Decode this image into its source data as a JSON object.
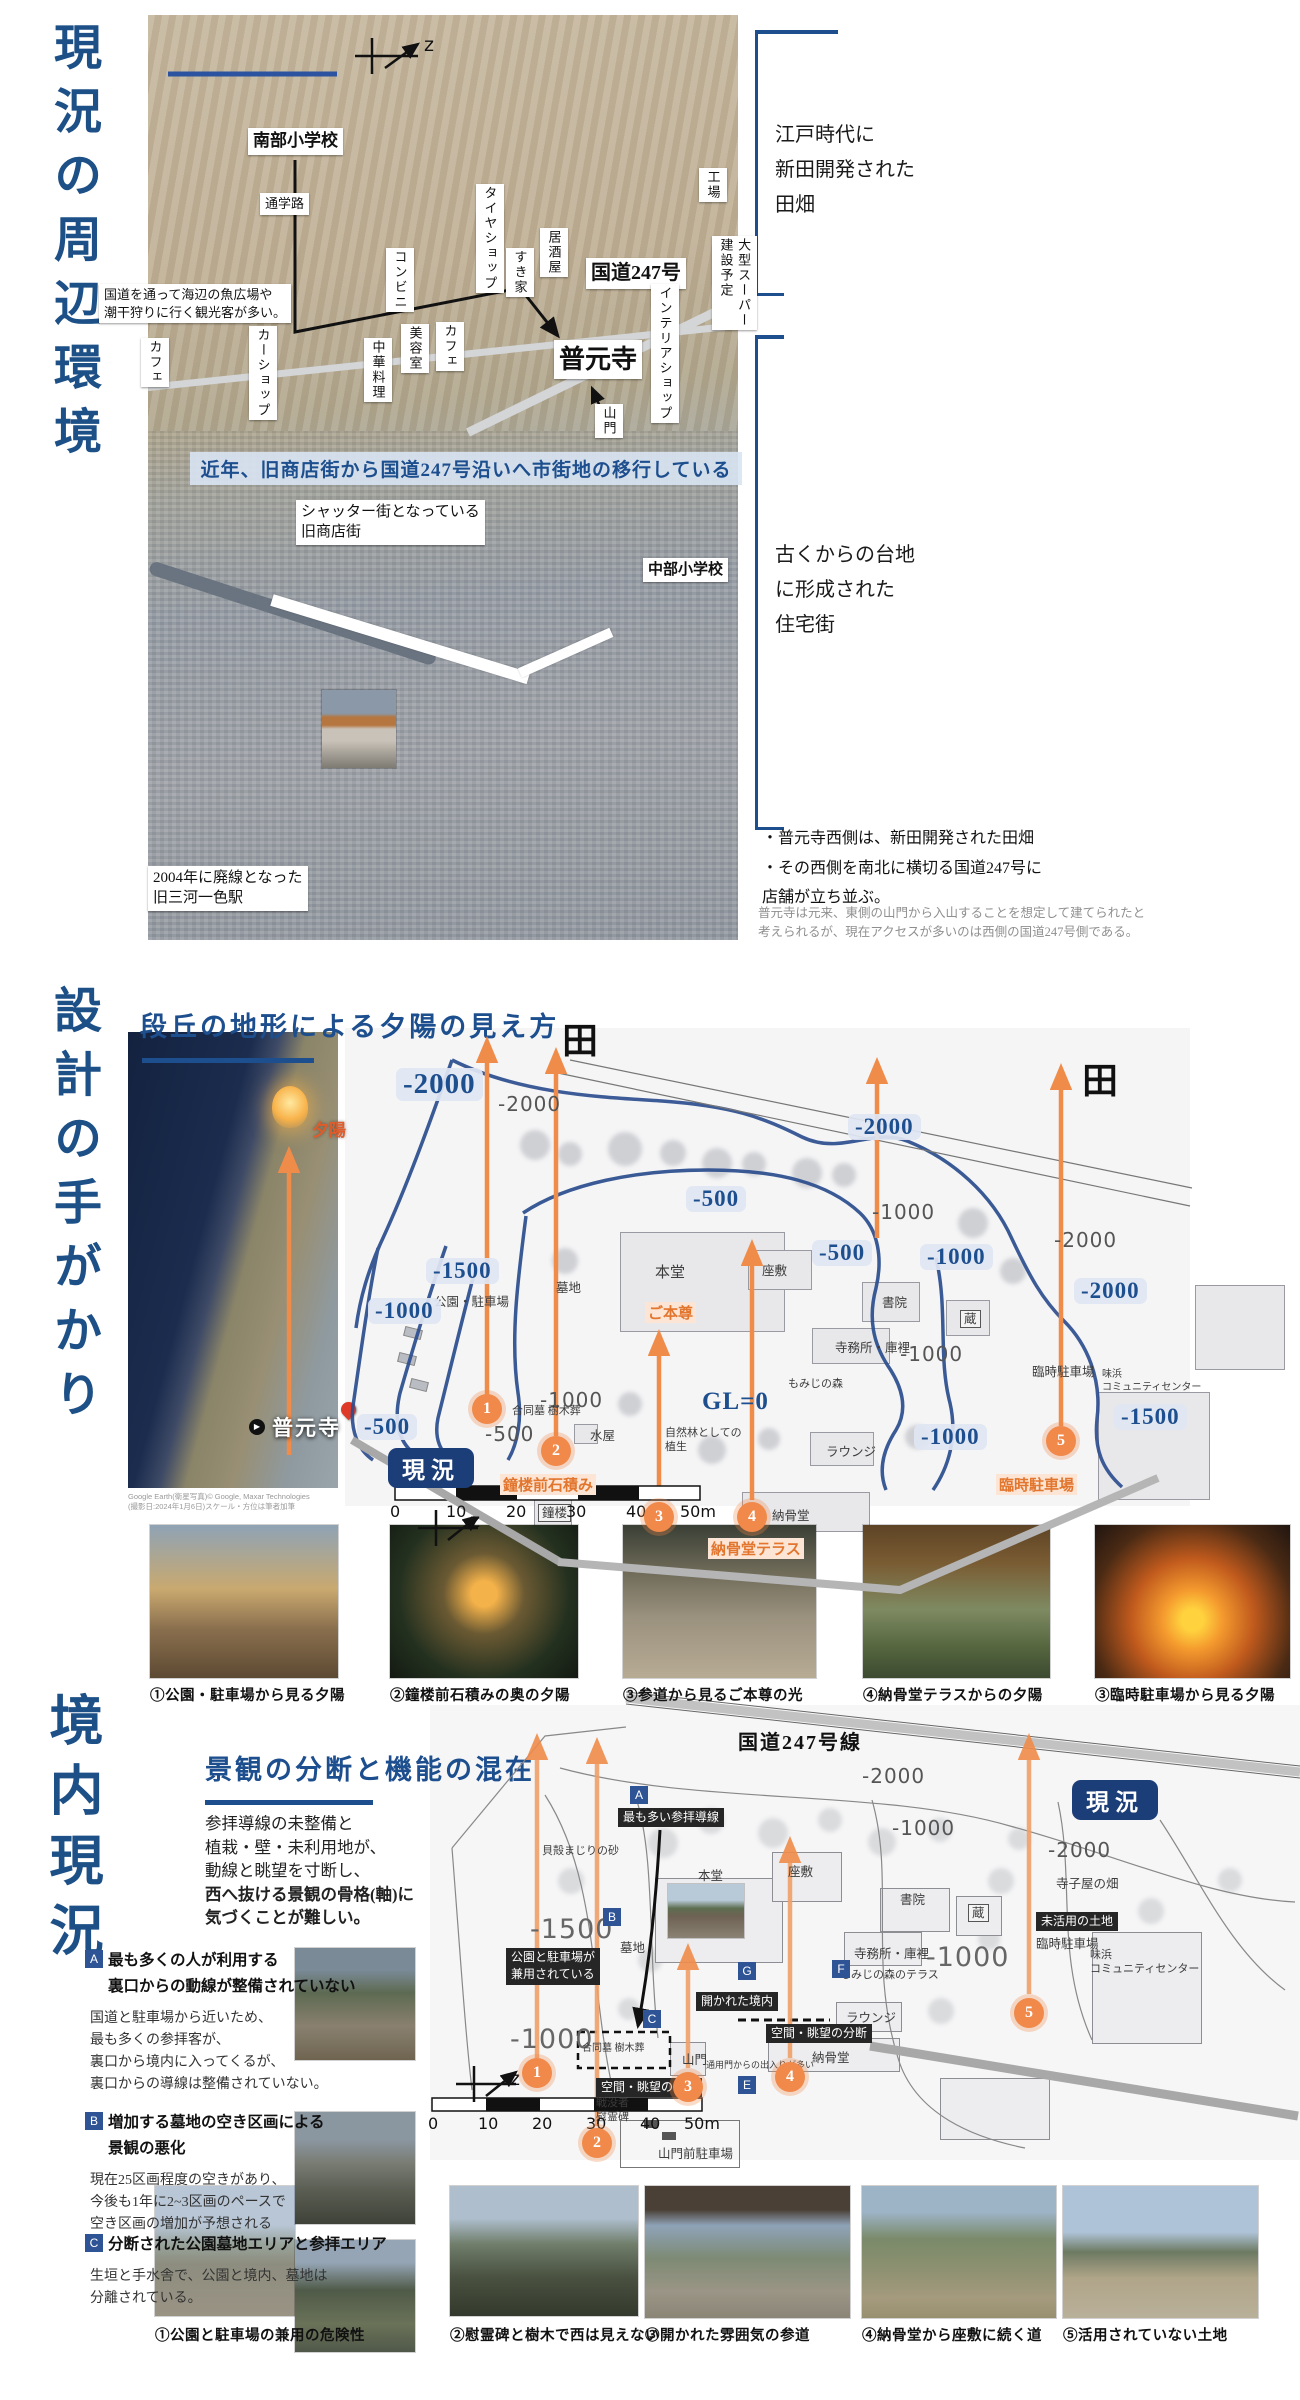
{
  "section1": {
    "title": "現況の周辺環境",
    "banner": "近年、旧商店街から国道247号沿いへ市街地の移行している",
    "map_labels": [
      {
        "t": "南部小学校",
        "x": 248,
        "y": 128,
        "b": 1,
        "s": 17
      },
      {
        "t": "通学路",
        "x": 260,
        "y": 193
      },
      {
        "t": "国道を通って海辺の魚広場や\n潮干狩りに行く観光客が多い。",
        "x": 99,
        "y": 284
      },
      {
        "t": "コンビニ",
        "x": 386,
        "y": 248,
        "v": 1
      },
      {
        "t": "タイヤショップ",
        "x": 476,
        "y": 184,
        "v": 1
      },
      {
        "t": "すき家",
        "x": 506,
        "y": 248,
        "v": 1
      },
      {
        "t": "居酒屋",
        "x": 540,
        "y": 228,
        "v": 1
      },
      {
        "t": "工場",
        "x": 699,
        "y": 168,
        "v": 1
      },
      {
        "t": "国道247号",
        "x": 586,
        "y": 258,
        "b": 1,
        "s": 20
      },
      {
        "t": "インテリアショップ",
        "x": 651,
        "y": 284,
        "v": 1
      },
      {
        "t": "大型スーパー\n建設予定",
        "x": 712,
        "y": 236,
        "v": 1
      },
      {
        "t": "カフェ",
        "x": 141,
        "y": 338,
        "v": 1
      },
      {
        "t": "カーショップ",
        "x": 249,
        "y": 326,
        "v": 1
      },
      {
        "t": "中華料理",
        "x": 364,
        "y": 338,
        "v": 1
      },
      {
        "t": "美容室",
        "x": 401,
        "y": 324,
        "v": 1
      },
      {
        "t": "カフェ",
        "x": 436,
        "y": 322,
        "v": 1
      },
      {
        "t": "普元寺",
        "x": 554,
        "y": 340,
        "b": 1,
        "s": 26
      },
      {
        "t": "山門",
        "x": 595,
        "y": 404,
        "v": 1
      },
      {
        "t": "シャッター街となっている\n旧商店街",
        "x": 296,
        "y": 500,
        "s": 15
      },
      {
        "t": "中部小学校",
        "x": 643,
        "y": 558,
        "b": 1,
        "s": 15
      },
      {
        "t": "2004年に廃線となった\n旧三河一色駅",
        "x": 148,
        "y": 866,
        "s": 15
      },
      {
        "t": "z",
        "x": 424,
        "y": 34,
        "c": "zlet",
        "n": "north-arrow-label"
      }
    ],
    "right": {
      "bracket1": "江戸時代に\n新田開発された\n田畑",
      "bracket2": "古くからの台地\nに形成された\n住宅街",
      "bullets": "・普元寺西側は、新田開発された田畑\n・その西側を南北に横切る国道247号に\n店舗が立ち並ぶ。",
      "note": "普元寺は元来、東側の山門から入山することを想定して建てられたと\n考えられるが、現在アクセスが多いのは西側の国道247号側である。"
    }
  },
  "section2": {
    "title": "設計の手がかり",
    "heading": "段丘の地形による夕陽の見え方",
    "photo_labels": [
      {
        "t": "夕陽",
        "x": 312,
        "y": 1116,
        "c": "sunlab",
        "n": "sunset-label"
      },
      {
        "t": "普元寺",
        "x": 272,
        "y": 1412,
        "c": "templelab",
        "n": "temple-name-label"
      },
      {
        "t": "▶",
        "x": 249,
        "y": 1419,
        "c": "playic",
        "n": "play-icon"
      },
      {
        "t": "Google Earth(衛星写真)© Google, Maxar Technologies",
        "x": 128,
        "y": 1491,
        "c": "credit",
        "n": "map-credit"
      },
      {
        "t": "(撮影日:2024年1月6日)スケール・方位は筆者加筆",
        "x": 128,
        "y": 1501,
        "c": "credit",
        "n": "map-credit"
      }
    ],
    "plan": {
      "badges": [
        {
          "t": "-2000",
          "x": 396,
          "y": 1068,
          "big": 1
        },
        {
          "t": "-1500",
          "x": 426,
          "y": 1258
        },
        {
          "t": "-1000",
          "x": 368,
          "y": 1298
        },
        {
          "t": "-500",
          "x": 357,
          "y": 1414
        },
        {
          "t": "-500",
          "x": 686,
          "y": 1186
        },
        {
          "t": "-2000",
          "x": 848,
          "y": 1114
        },
        {
          "t": "-500",
          "x": 812,
          "y": 1240
        },
        {
          "t": "-1000",
          "x": 920,
          "y": 1244
        },
        {
          "t": "-2000",
          "x": 1074,
          "y": 1278
        },
        {
          "t": "-1500",
          "x": 1114,
          "y": 1404
        },
        {
          "t": "-1000",
          "x": 914,
          "y": 1424
        }
      ],
      "plains": [
        {
          "t": "-2000",
          "x": 498,
          "y": 1092
        },
        {
          "t": "-1000",
          "x": 872,
          "y": 1200
        },
        {
          "t": "-2000",
          "x": 1054,
          "y": 1228
        },
        {
          "t": "-1000",
          "x": 900,
          "y": 1342
        },
        {
          "t": "-1000",
          "x": 540,
          "y": 1388
        },
        {
          "t": "-500",
          "x": 485,
          "y": 1422
        }
      ],
      "areas": [
        {
          "t": "公園・駐車場",
          "x": 434,
          "y": 1294
        },
        {
          "t": "墓地",
          "x": 556,
          "y": 1280
        },
        {
          "t": "本堂",
          "x": 655,
          "y": 1264,
          "s": 15
        },
        {
          "t": "座敷",
          "x": 762,
          "y": 1263
        },
        {
          "t": "書院",
          "x": 882,
          "y": 1295
        },
        {
          "t": "蔵",
          "x": 960,
          "y": 1310,
          "box": 1
        },
        {
          "t": "寺務所・庫裡",
          "x": 835,
          "y": 1340
        },
        {
          "t": "もみじの森",
          "x": 788,
          "y": 1377,
          "s": 11
        },
        {
          "t": "ラウンジ",
          "x": 826,
          "y": 1444
        },
        {
          "t": "臨時駐車場",
          "x": 1032,
          "y": 1364
        },
        {
          "t": "味浜\nコミュニティセンター",
          "x": 1102,
          "y": 1368,
          "s": 10
        },
        {
          "t": "水屋",
          "x": 590,
          "y": 1428
        },
        {
          "t": "合同墓 樹木葬",
          "x": 512,
          "y": 1404,
          "s": 11
        },
        {
          "t": "自然林としての\n植生",
          "x": 665,
          "y": 1426,
          "s": 11
        },
        {
          "t": "鐘楼",
          "x": 538,
          "y": 1504,
          "box": 1
        },
        {
          "t": "納骨堂",
          "x": 772,
          "y": 1508
        },
        {
          "t": "田",
          "x": 562,
          "y": 1012,
          "c": "ta",
          "n": "rice-field-label"
        },
        {
          "t": "田",
          "x": 1082,
          "y": 1052,
          "c": "ta",
          "n": "rice-field-label"
        },
        {
          "t": "GL=0",
          "x": 702,
          "y": 1388,
          "c": "gl",
          "n": "ground-level-label"
        },
        {
          "t": "現況",
          "x": 388,
          "y": 1448,
          "c": "statusbadge",
          "n": "status-badge"
        },
        {
          "t": "z",
          "x": 470,
          "y": 1510,
          "c": "zlet",
          "n": "north-arrow-label"
        },
        {
          "t": "0",
          "x": 390,
          "y": 1502,
          "c": "sclab",
          "n": "scale-tick"
        },
        {
          "t": "10",
          "x": 446,
          "y": 1502,
          "c": "sclab",
          "n": "scale-tick"
        },
        {
          "t": "20",
          "x": 506,
          "y": 1502,
          "c": "sclab",
          "n": "scale-tick"
        },
        {
          "t": "30",
          "x": 566,
          "y": 1502,
          "c": "sclab",
          "n": "scale-tick"
        },
        {
          "t": "40",
          "x": 626,
          "y": 1502,
          "c": "sclab",
          "n": "scale-tick"
        },
        {
          "t": "50m",
          "x": 680,
          "y": 1502,
          "c": "sclab",
          "n": "scale-tick"
        }
      ],
      "orange_texts": [
        {
          "t": "ご本尊",
          "x": 645,
          "y": 1302
        },
        {
          "t": "鐘楼前石積み",
          "x": 500,
          "y": 1474
        },
        {
          "t": "納骨堂テラス",
          "x": 708,
          "y": 1538
        },
        {
          "t": "臨時駐車場",
          "x": 996,
          "y": 1474
        }
      ],
      "circles": [
        {
          "t": "1",
          "x": 472,
          "y": 1394
        },
        {
          "t": "2",
          "x": 541,
          "y": 1436
        },
        {
          "t": "3",
          "x": 644,
          "y": 1502
        },
        {
          "t": "4",
          "x": 737,
          "y": 1502
        },
        {
          "t": "5",
          "x": 1046,
          "y": 1426
        }
      ]
    },
    "captions": [
      {
        "t": "①公園・駐車場から見る夕陽",
        "x": 150,
        "y": 1684
      },
      {
        "t": "②鐘楼前石積みの奥の夕陽",
        "x": 390,
        "y": 1684
      },
      {
        "t": "③参道から見るご本尊の光",
        "x": 623,
        "y": 1684
      },
      {
        "t": "④納骨堂テラスからの夕陽",
        "x": 863,
        "y": 1684
      },
      {
        "t": "③臨時駐車場から見る夕陽",
        "x": 1095,
        "y": 1684
      }
    ]
  },
  "section3": {
    "title": "境内現況",
    "heading": "景観の分断と機能の混在",
    "para": [
      {
        "t": "参拝導線の未整備と"
      },
      {
        "t": "植栽・壁・未利用地が、"
      },
      {
        "t": "動線と眺望を寸断し、"
      },
      {
        "t": "西へ抜ける景観の骨格(軸)に",
        "b": 1
      },
      {
        "t": "気づくことが難しい。",
        "b": 1
      }
    ],
    "issues": [
      {
        "key": "A",
        "y": 1948,
        "title": "最も多くの人が利用する\n裏口からの動線が整備されていない",
        "body": "国道と駐車場から近いため、\n最も多くの参拝客が、\n裏口から境内に入ってくるが、\n裏口からの導線は整備されていない。"
      },
      {
        "key": "B",
        "y": 2110,
        "title": "増加する墓地の空き区画による\n景観の悪化",
        "body": "現在25区画程度の空きがあり、\n今後も1年に2~3区画のペースで\n空き区画の増加が予想される"
      },
      {
        "key": "C",
        "y": 2232,
        "title": "分断された公園墓地エリアと参拝エリア",
        "body": "生垣と手水舎で、公園と境内、墓地は\n分離されている。"
      }
    ],
    "plan": {
      "dark_badges": [
        {
          "t": "最も多い参拝導線",
          "x": 618,
          "y": 1808
        },
        {
          "t": "公園と駐車場が\n兼用されている",
          "x": 506,
          "y": 1948
        },
        {
          "t": "空間・眺望の分断",
          "x": 596,
          "y": 2078
        },
        {
          "t": "空間・眺望の分断",
          "x": 766,
          "y": 2024
        },
        {
          "t": "開かれた境内",
          "x": 696,
          "y": 1992
        },
        {
          "t": "未活用の土地",
          "x": 1036,
          "y": 1912
        }
      ],
      "blue_markers": [
        {
          "t": "A",
          "x": 630,
          "y": 1786
        },
        {
          "t": "B",
          "x": 603,
          "y": 1908
        },
        {
          "t": "C",
          "x": 643,
          "y": 2010
        },
        {
          "t": "E",
          "x": 738,
          "y": 2076
        },
        {
          "t": "F",
          "x": 832,
          "y": 1960
        },
        {
          "t": "G",
          "x": 738,
          "y": 1962
        }
      ],
      "contours": [
        {
          "t": "-2000",
          "x": 862,
          "y": 1764
        },
        {
          "t": "-1000",
          "x": 892,
          "y": 1816
        },
        {
          "t": "-2000",
          "x": 1048,
          "y": 1838
        },
        {
          "t": "-1000",
          "x": 926,
          "y": 1942,
          "big": 1
        },
        {
          "t": "-1500",
          "x": 530,
          "y": 1914,
          "big": 1
        },
        {
          "t": "-1000",
          "x": 510,
          "y": 2024,
          "big": 1
        }
      ],
      "areas": [
        {
          "t": "寺子屋の畑",
          "x": 1056,
          "y": 1876
        },
        {
          "t": "本堂",
          "x": 698,
          "y": 1868
        },
        {
          "t": "座敷",
          "x": 788,
          "y": 1864
        },
        {
          "t": "書院",
          "x": 900,
          "y": 1892
        },
        {
          "t": "蔵",
          "x": 968,
          "y": 1904,
          "box": 1
        },
        {
          "t": "寺務所・庫裡",
          "x": 854,
          "y": 1946
        },
        {
          "t": "もみじの森のテラス",
          "x": 840,
          "y": 1968,
          "s": 11
        },
        {
          "t": "ラウンジ",
          "x": 846,
          "y": 2010
        },
        {
          "t": "山門",
          "x": 682,
          "y": 2052
        },
        {
          "t": "納骨堂",
          "x": 812,
          "y": 2050
        },
        {
          "t": "臨時駐車場",
          "x": 1036,
          "y": 1936
        },
        {
          "t": "味浜\nコミュニティセンター",
          "x": 1090,
          "y": 1948,
          "s": 11
        },
        {
          "t": "墓地",
          "x": 620,
          "y": 1940
        },
        {
          "t": "貝殻まじりの砂",
          "x": 542,
          "y": 1844,
          "s": 11
        },
        {
          "t": "戦没者\n慰霊碑",
          "x": 596,
          "y": 2096,
          "s": 11
        },
        {
          "t": "合同墓 樹木葬",
          "x": 582,
          "y": 2042,
          "s": 10
        },
        {
          "t": "山門前駐車場",
          "x": 658,
          "y": 2146
        },
        {
          "t": "通用門からの出入りが多い",
          "x": 706,
          "y": 2060,
          "s": 9
        },
        {
          "t": "国道247号線",
          "x": 738,
          "y": 1726,
          "c": "roadlab",
          "n": "route247-label"
        },
        {
          "t": "現況",
          "x": 1072,
          "y": 1780,
          "c": "statusbadge",
          "n": "status-badge"
        },
        {
          "t": "z",
          "x": 510,
          "y": 2068,
          "c": "zlet",
          "n": "north-arrow-label"
        },
        {
          "t": "0",
          "x": 428,
          "y": 2114,
          "c": "sclab",
          "n": "scale-tick"
        },
        {
          "t": "10",
          "x": 478,
          "y": 2114,
          "c": "sclab",
          "n": "scale-tick"
        },
        {
          "t": "20",
          "x": 532,
          "y": 2114,
          "c": "sclab",
          "n": "scale-tick"
        },
        {
          "t": "30",
          "x": 586,
          "y": 2114,
          "c": "sclab",
          "n": "scale-tick"
        },
        {
          "t": "40",
          "x": 640,
          "y": 2114,
          "c": "sclab",
          "n": "scale-tick"
        },
        {
          "t": "50m",
          "x": 684,
          "y": 2114,
          "c": "sclab",
          "n": "scale-tick"
        }
      ],
      "circles": [
        {
          "t": "1",
          "x": 522,
          "y": 2058
        },
        {
          "t": "2",
          "x": 582,
          "y": 2128
        },
        {
          "t": "3",
          "x": 673,
          "y": 2072
        },
        {
          "t": "4",
          "x": 775,
          "y": 2062
        },
        {
          "t": "5",
          "x": 1014,
          "y": 1998
        }
      ]
    },
    "captions": [
      {
        "t": "①公園と駐車場の兼用の危険性",
        "x": 155,
        "y": 2324
      },
      {
        "t": "②慰霊碑と樹木で西は見えない",
        "x": 450,
        "y": 2324
      },
      {
        "t": "③開かれた雰囲気の参道",
        "x": 645,
        "y": 2324
      },
      {
        "t": "④納骨堂から座敷に続く道",
        "x": 862,
        "y": 2324
      },
      {
        "t": "⑤活用されていない土地",
        "x": 1063,
        "y": 2324
      }
    ]
  }
}
